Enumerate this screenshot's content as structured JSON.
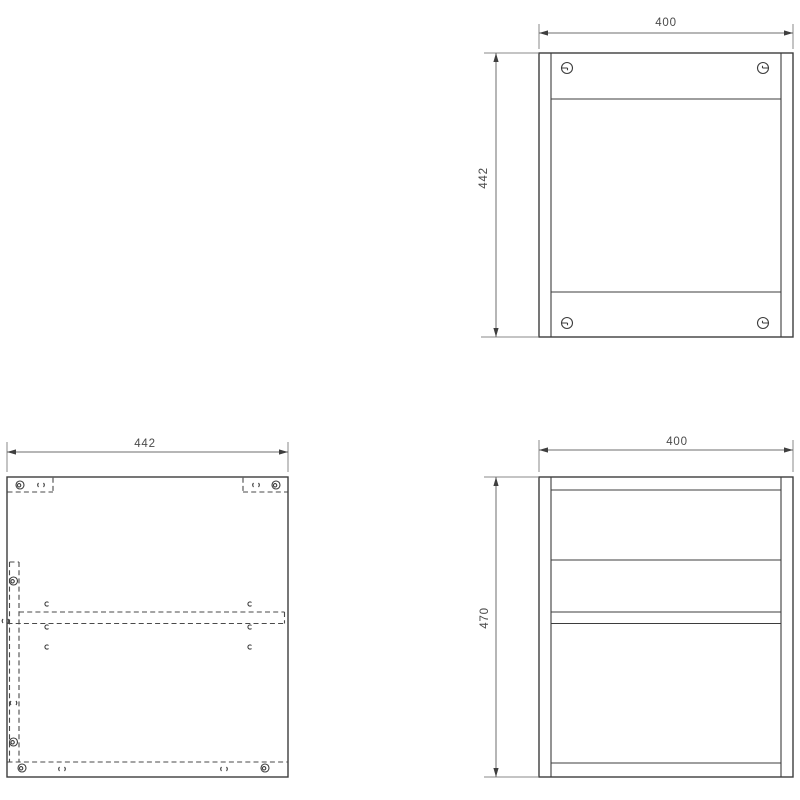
{
  "drawing": {
    "colors": {
      "background": "#ffffff",
      "object_line": "#3d3d3d",
      "dimension_line": "#6e6e6e",
      "dashed_line": "#4a4a4a",
      "text": "#4a4a4a"
    },
    "views": {
      "back_panel": {
        "dim_width": "400",
        "dim_height": "442"
      },
      "panel_plan": {
        "dim_width": "442"
      },
      "front": {
        "dim_width": "400",
        "dim_height": "470"
      }
    }
  }
}
